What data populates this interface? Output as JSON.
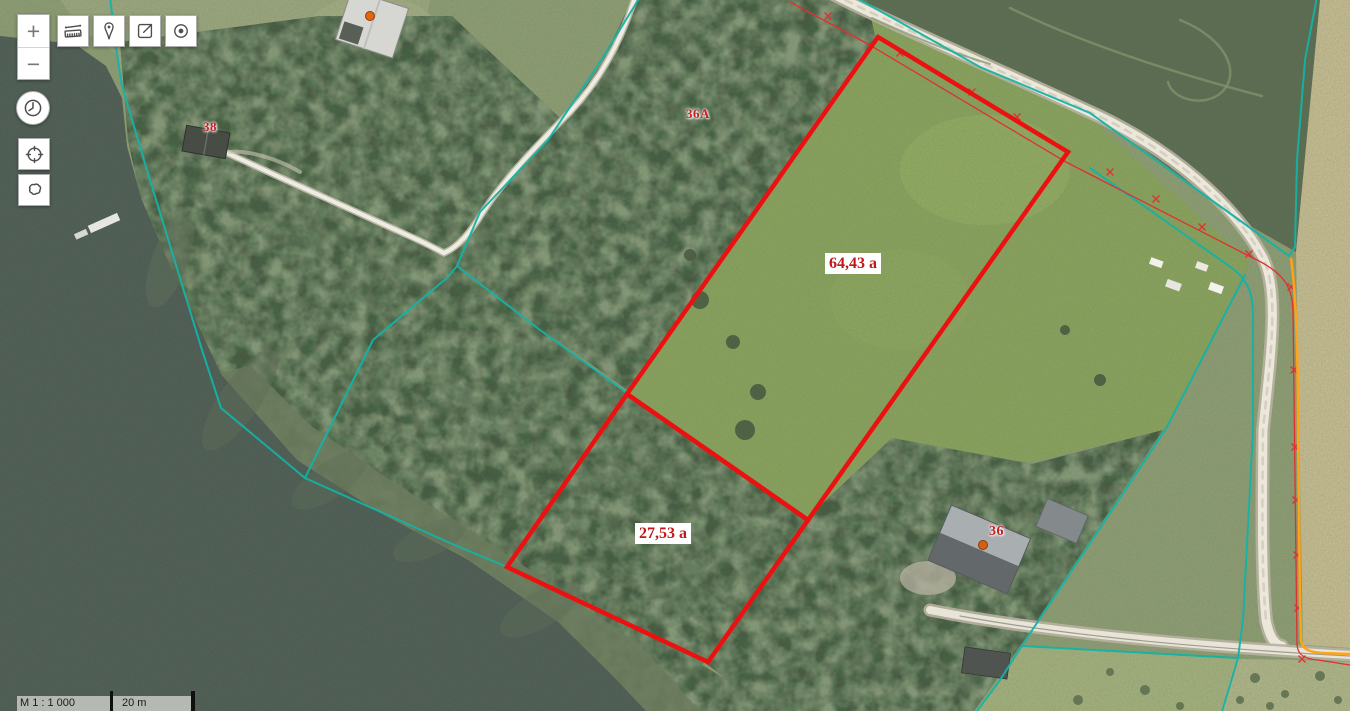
{
  "controls": {
    "zoom_in_label": "+",
    "zoom_out_label": "−",
    "toolbar_icons": [
      "ruler-icon",
      "marker-icon",
      "share-icon",
      "target-icon"
    ],
    "side_icons": [
      "clock-icon",
      "crosshair-icon",
      "polygon-icon"
    ]
  },
  "scalebar": {
    "scale_text": "M 1 : 1 000",
    "bar_text": "20 m"
  },
  "map_labels": {
    "parcel_38": "38",
    "parcel_36a": "36A",
    "parcel_36": "36",
    "area_big": "64,43 a",
    "area_small": "27,53 a"
  },
  "colors": {
    "cadastral_line": "#14b3a6",
    "parcel_outline": "#ec1111",
    "survey_marker_line": "#e03030",
    "reference_line": "#ffa418",
    "label_red": "#c32020"
  }
}
